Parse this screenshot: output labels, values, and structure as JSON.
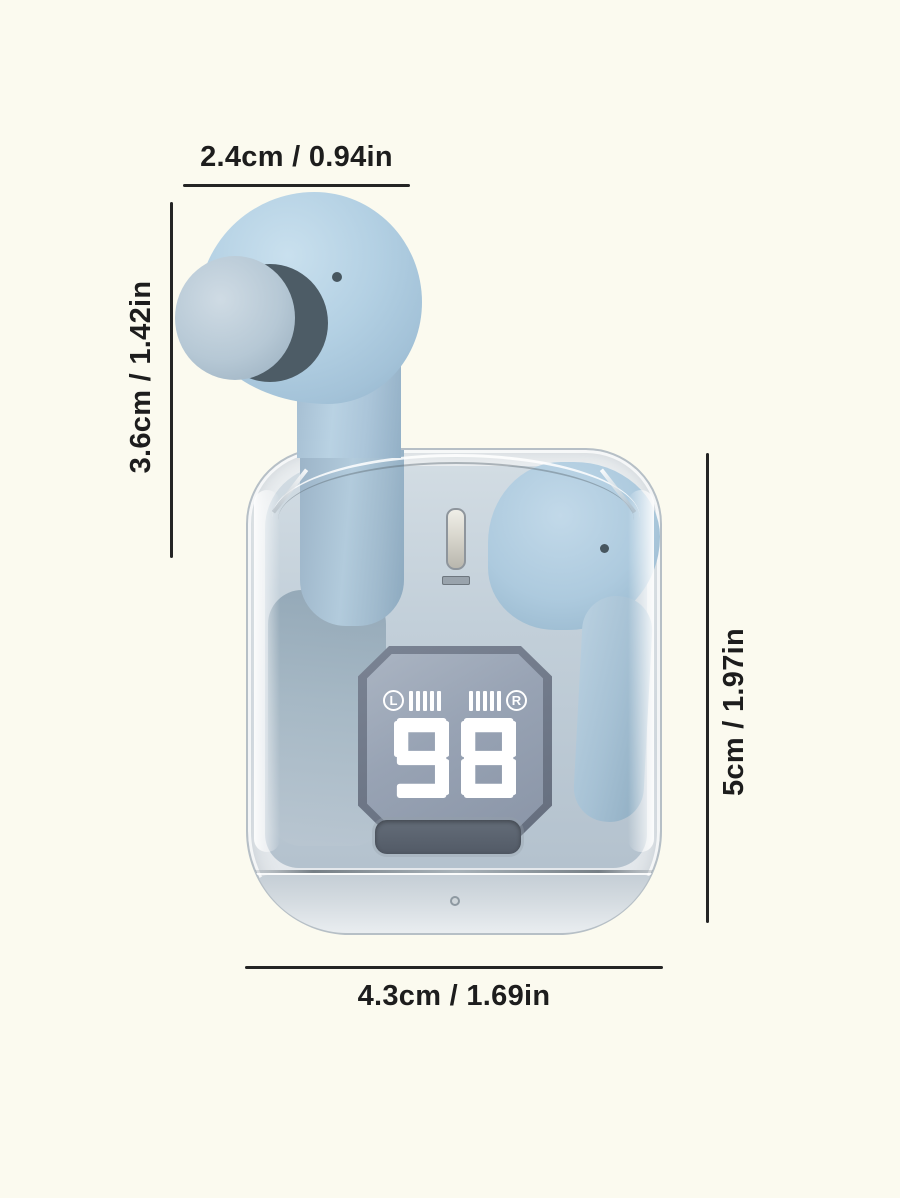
{
  "scene": {
    "background_color": "#fbfaef",
    "annotation_color": "#1d1d1d"
  },
  "annotations": {
    "earbud_width": "2.4cm / 0.94in",
    "earbud_height": "3.6cm / 1.42in",
    "case_height": "5cm / 1.97in",
    "case_width": "4.3cm / 1.69in"
  },
  "product": {
    "name": "wireless-earbuds-with-transparent-charging-case",
    "display": {
      "battery_level": "98",
      "left_channel": "L",
      "right_channel": "R",
      "left_battery_bars": 5,
      "right_battery_bars": 5,
      "panel_color": "#97a2b4",
      "digit_color": "#ffffff"
    },
    "colors": {
      "earbud_blue": "#b0cde1",
      "earbud_shadow": "#8fb2c9",
      "ear_tip": "#b4c6d4",
      "case_interior": "#bcc9d4",
      "display_frame": "#6f7888",
      "shell_edge": "#b6bfc6"
    }
  }
}
